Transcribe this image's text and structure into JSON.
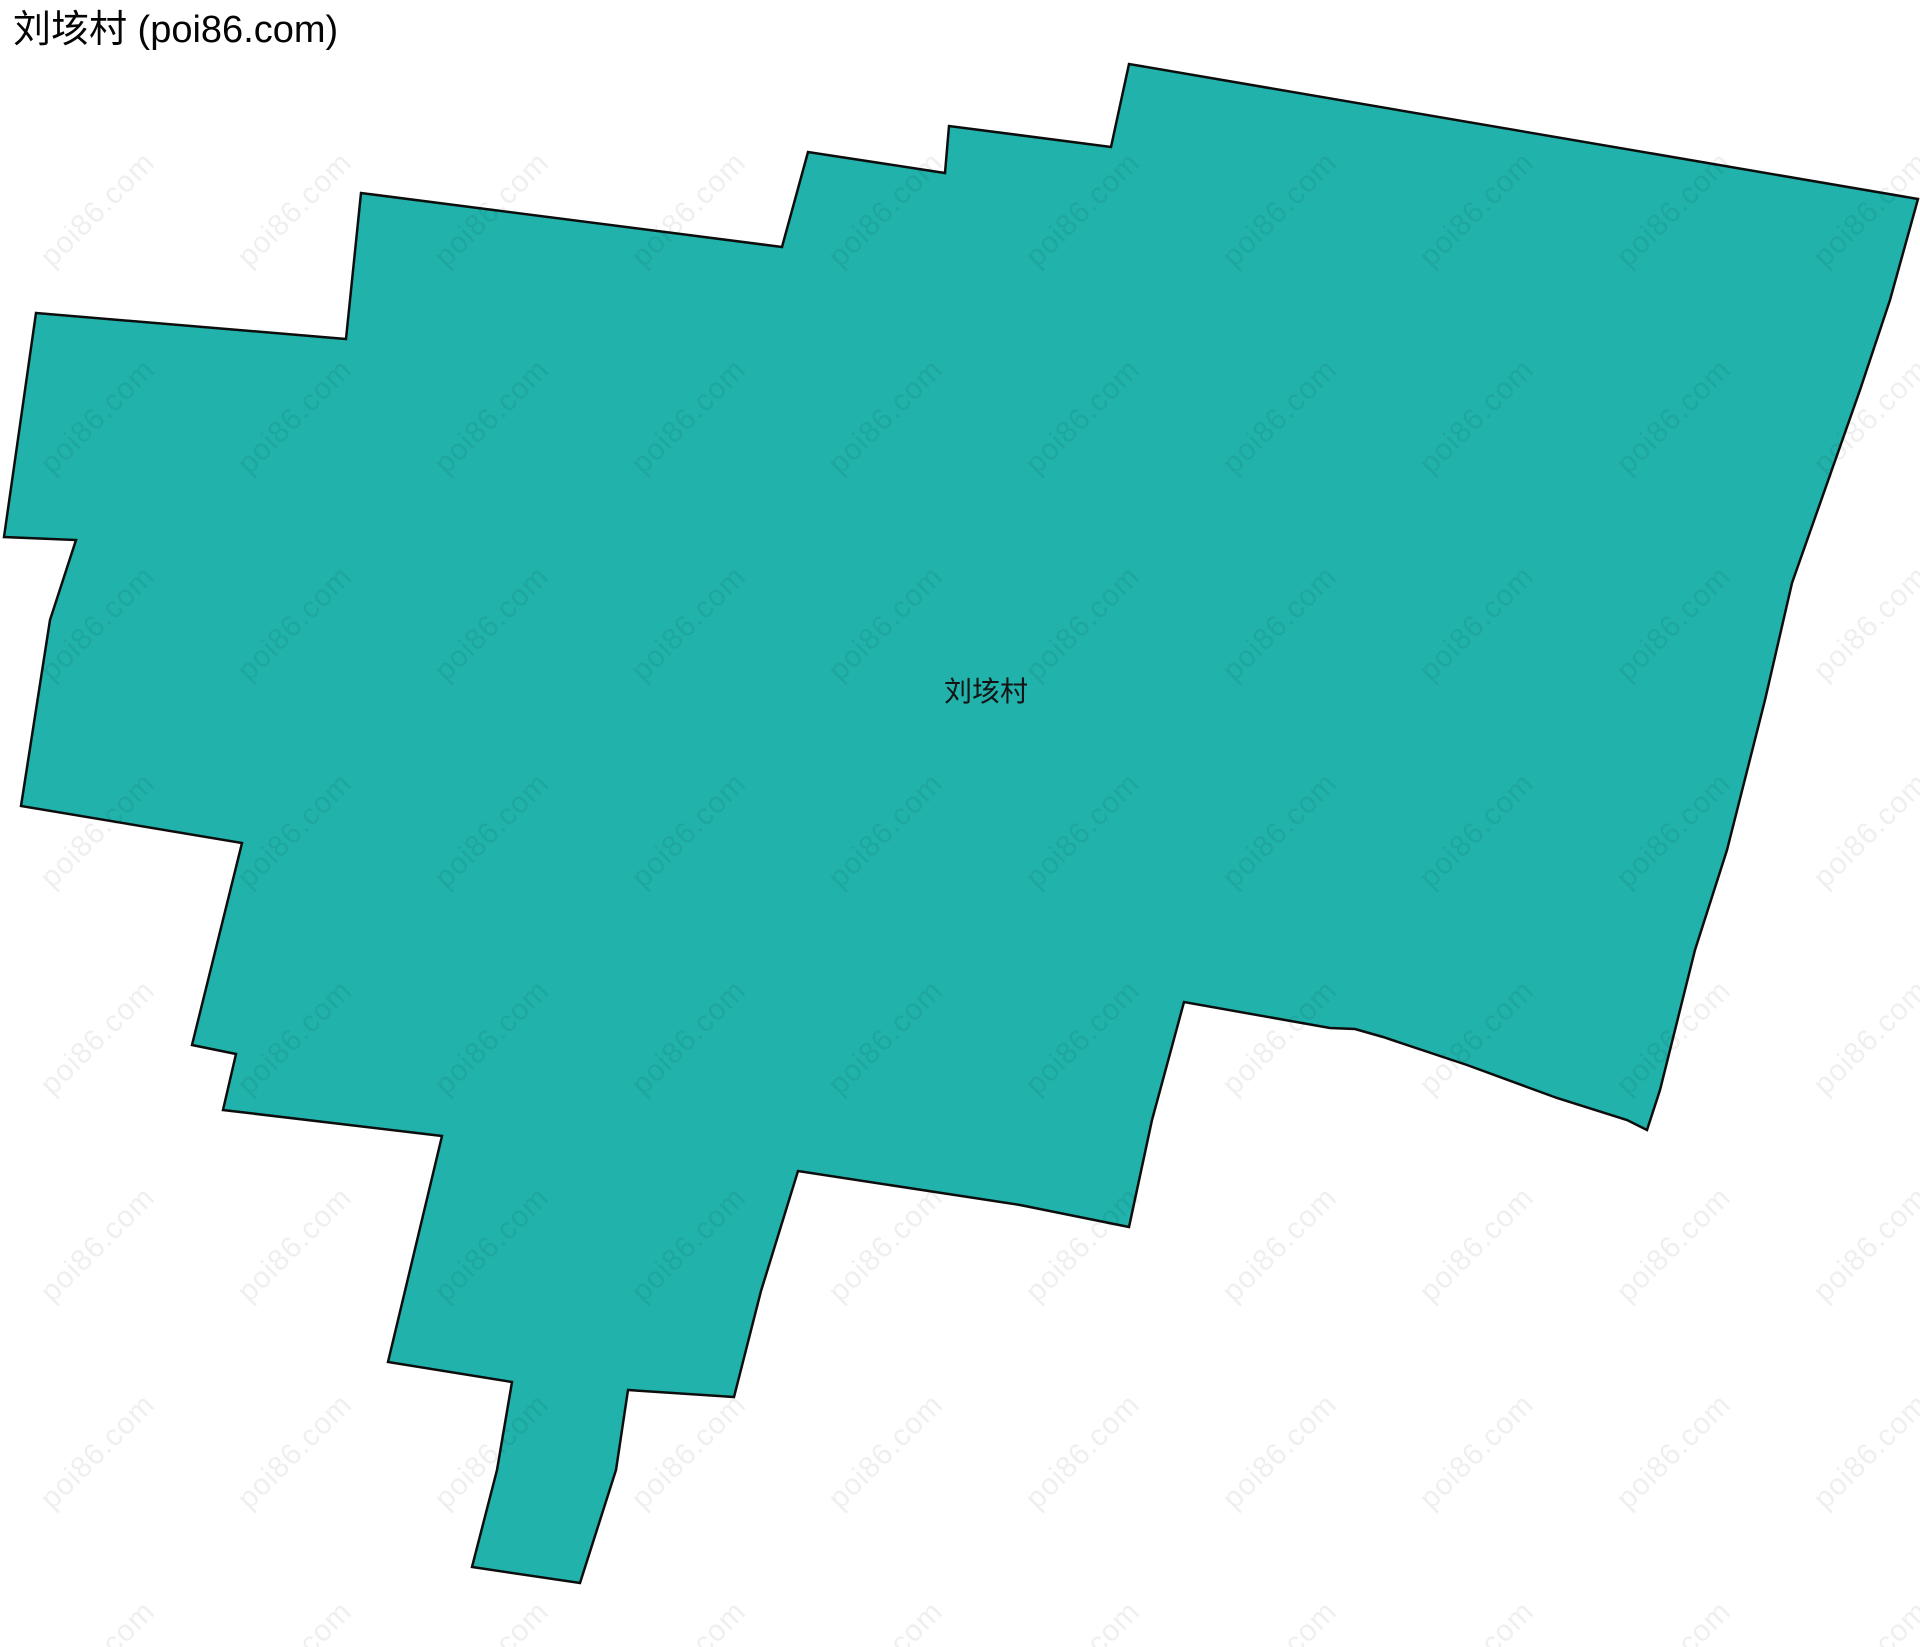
{
  "page": {
    "title": "刘垓村 (poi86.com)",
    "background_color": "#ffffff"
  },
  "map": {
    "region_label": "刘垓村",
    "fill_color": "#21b2ab",
    "stroke_color": "#0d0d0d",
    "stroke_width": "2.5",
    "polygon_points": "36,313 346,339 361,193 782,247 808,152 945,173 949,126 1111,147 1129,64 1918,199 1890,300 1860,390 1792,583 1765,700 1727,850 1695,950 1660,1090 1647,1130 1627,1120 1557,1098 1467,1065 1383,1037 1355,1029 1330,1028 1184,1002 1152,1120 1129,1227 1020,1205 798,1171 761,1291 734,1397 628,1390 616,1470 580,1583 472,1567 497,1470 512,1382 388,1362 442,1136 223,1110 236,1054 192,1045 242,843 21,806 50,620 76,540 4,537",
    "label_x": "986",
    "label_y": "690"
  },
  "watermark": {
    "text": "poi86.com",
    "color": "rgba(0,0,0,0.062)",
    "font_size_px": 30,
    "rotation_deg": -45,
    "start_x": 98,
    "start_y": 210,
    "pitch_x": 197,
    "pitch_y": 207,
    "cols": 10,
    "rows": 8
  }
}
